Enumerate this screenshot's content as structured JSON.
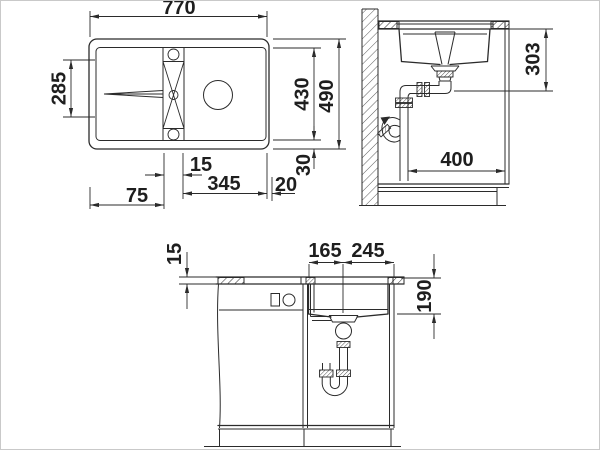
{
  "drawing": {
    "type": "sink installation dimension drawing",
    "line_color": "#2b2b2b",
    "background": "#ffffff",
    "top_view": {
      "name": "top view",
      "dims": {
        "overall_width": "770",
        "drainboard_length": "285",
        "tap_offset": "15",
        "bowl_width": "345",
        "left_margin": "75",
        "right_margin": "20",
        "inner_depth": "430",
        "overall_depth": "490",
        "edge_margin": "30"
      }
    },
    "side_view": {
      "name": "side section",
      "dims": {
        "install_depth": "303",
        "cabinet_depth": "400"
      }
    },
    "front_view": {
      "name": "front section",
      "dims": {
        "countertop_thickness": "15",
        "drain_offset_left": "165",
        "drain_offset_right": "245",
        "bowl_depth": "190"
      }
    }
  }
}
